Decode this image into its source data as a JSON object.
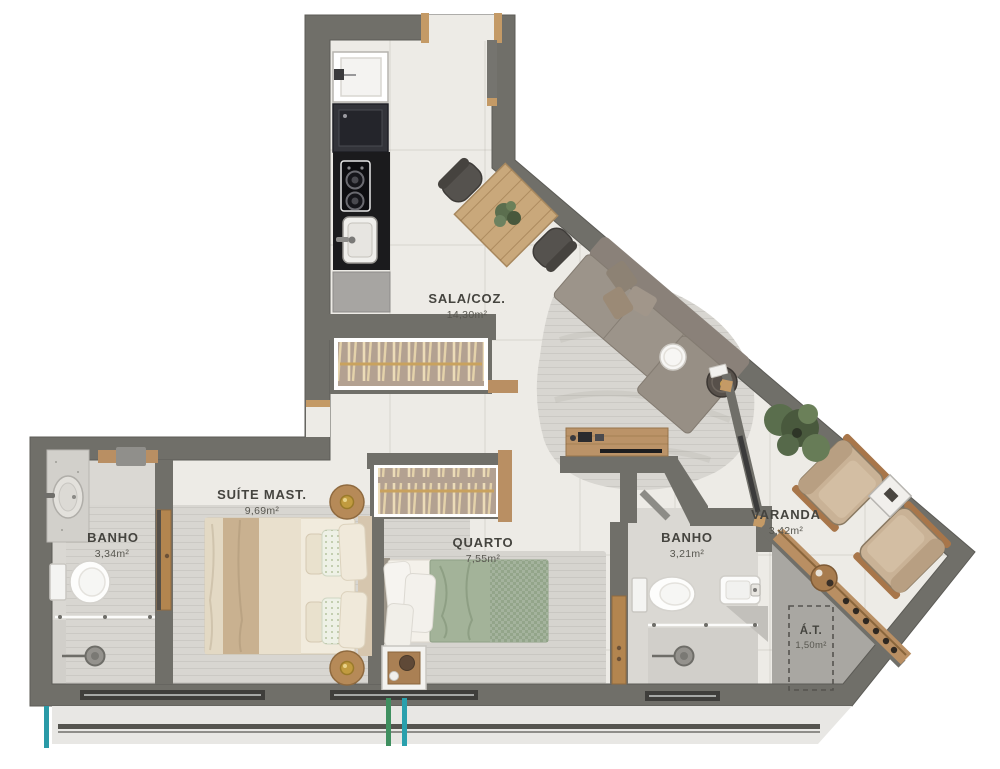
{
  "plan_title": "apartment-floor-plan",
  "rooms": {
    "sala": {
      "name": "SALA/COZ.",
      "area": "14,30m²"
    },
    "suite": {
      "name": "SUÍTE MAST.",
      "area": "9,69m²"
    },
    "banho1": {
      "name": "BANHO",
      "area": "3,34m²"
    },
    "quarto": {
      "name": "QUARTO",
      "area": "7,55m²"
    },
    "banho2": {
      "name": "BANHO",
      "area": "3,21m²"
    },
    "varanda": {
      "name": "VARANDA",
      "area": "3,42m²"
    },
    "at": {
      "name": "Á.T.",
      "area": "1,50m²"
    }
  },
  "colors": {
    "wall": "#706f69",
    "floor": "#edebe6",
    "bath_floor": "#dad8d3",
    "service_floor": "#a9a7a2",
    "rug": "#d8d6d1",
    "wood": "#bb9368",
    "counter_black": "#1b1b1d",
    "sofa": "#9c948a",
    "bed_suite": "#ece4d3",
    "bed_quarto_green": "#a3b399",
    "pipe_green": "#3f8f5f",
    "pipe_teal": "#2a9aa7"
  }
}
